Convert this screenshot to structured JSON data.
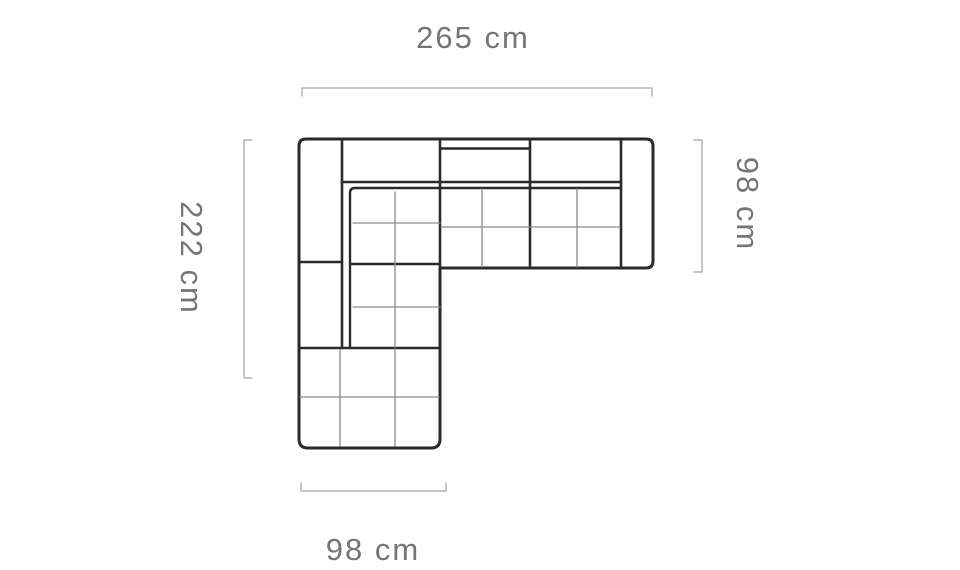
{
  "diagram": {
    "subject": "corner-sofa-top-view-dimension-drawing",
    "dimensions": {
      "top": {
        "label": "265 cm",
        "value_cm": 265,
        "side": "top"
      },
      "left": {
        "label": "222 cm",
        "value_cm": 222,
        "side": "left"
      },
      "right": {
        "label": "98 cm",
        "value_cm": 98,
        "side": "right"
      },
      "bottom": {
        "label": "98 cm",
        "value_cm": 98,
        "side": "bottom"
      }
    },
    "colors": {
      "outline": "#2a2a2a",
      "seam_line": "#8a8a8a",
      "dimension_line": "#b3b3b3",
      "label_text": "#757575",
      "background": "#ffffff"
    }
  }
}
